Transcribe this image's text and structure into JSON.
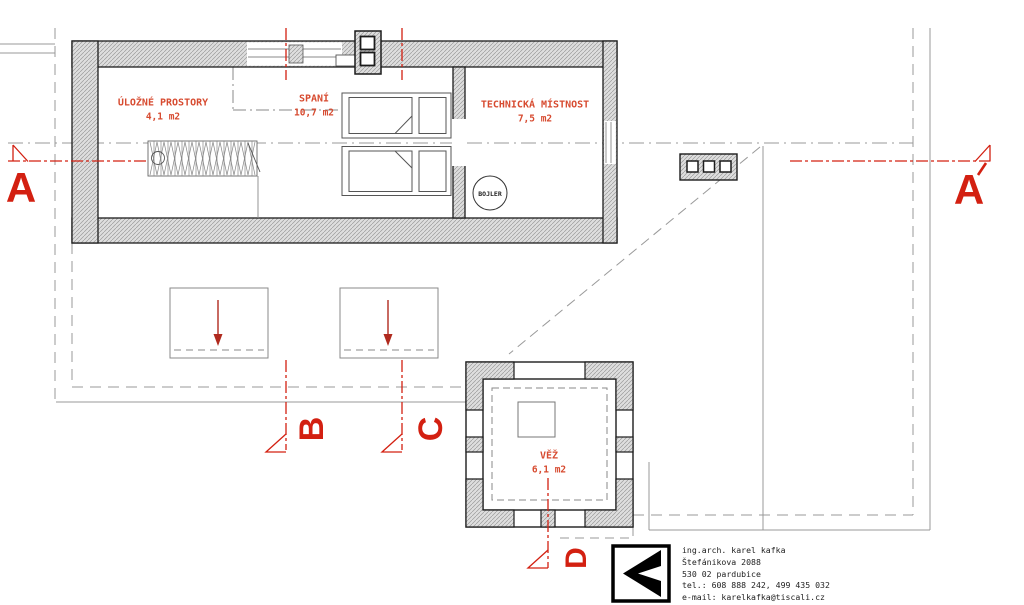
{
  "rooms": [
    {
      "name": "ÚLOŽNÉ PROSTORY",
      "area": "4,1 m2"
    },
    {
      "name": "SPANÍ",
      "area": "10,7 m2"
    },
    {
      "name": "TECHNICKÁ MÍSTNOST",
      "area": "7,5 m2"
    },
    {
      "name": "VĚŽ",
      "area": "6,1 m2"
    }
  ],
  "equipment": {
    "boiler": "BOJLER"
  },
  "section_markers": {
    "a": "A",
    "a_prime": "A´",
    "b": "B",
    "c": "C",
    "d": "D"
  },
  "title_block": {
    "architect": "ing.arch. karel kafka",
    "street": "Štefánikova 2088",
    "city": "530 02 pardubice",
    "phone": "tel.: 608 888 242, 499 435 032",
    "email": "e-mail: karelkafka@tiscali.cz"
  },
  "colors": {
    "section_red": "#d32011",
    "label_red": "#d74b30",
    "line_gray": "#8a8a8a",
    "wall_fill": "#dedede",
    "hatch_line": "#9a9a9a",
    "ink": "#1c1c1c"
  }
}
